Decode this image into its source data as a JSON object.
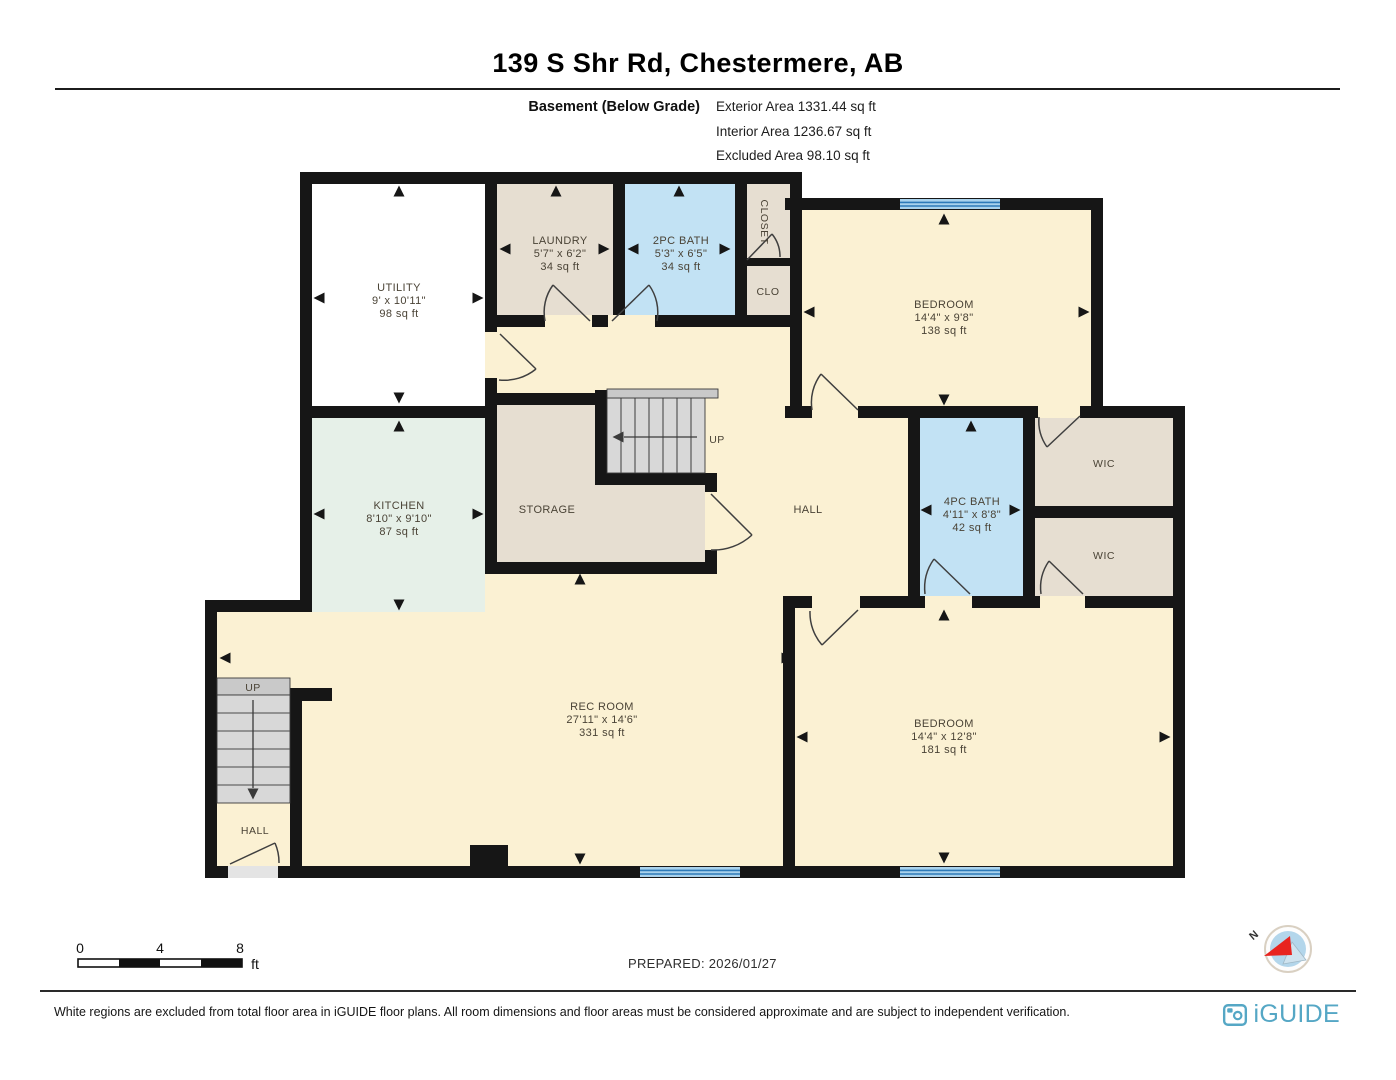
{
  "header": {
    "title": "139 S Shr Rd, Chestermere, AB",
    "floor_label": "Basement (Below Grade)",
    "area_lines": [
      "Exterior Area 1331.44 sq ft",
      "Interior Area 1236.67 sq ft",
      "Excluded Area 98.10 sq ft"
    ]
  },
  "floorplan": {
    "rooms": {
      "utility": {
        "name": "UTILITY",
        "dims": "9' x 10'11\"",
        "area": "98 sq ft"
      },
      "laundry": {
        "name": "LAUNDRY",
        "dims": "5'7\" x 6'2\"",
        "area": "34 sq ft"
      },
      "bath_2pc": {
        "name": "2PC BATH",
        "dims": "5'3\" x 6'5\"",
        "area": "34 sq ft"
      },
      "closet": {
        "name": "CLOSET"
      },
      "clo": {
        "name": "CLO"
      },
      "bedroom_upper": {
        "name": "BEDROOM",
        "dims": "14'4\" x 9'8\"",
        "area": "138 sq ft"
      },
      "kitchen": {
        "name": "KITCHEN",
        "dims": "8'10\" x 9'10\"",
        "area": "87 sq ft"
      },
      "storage": {
        "name": "STORAGE"
      },
      "hall": {
        "name": "HALL"
      },
      "bath_4pc": {
        "name": "4PC BATH",
        "dims": "4'11\" x 8'8\"",
        "area": "42 sq ft"
      },
      "wic_upper": {
        "name": "WIC"
      },
      "wic_lower": {
        "name": "WIC"
      },
      "rec_room": {
        "name": "REC ROOM",
        "dims": "27'11\" x 14'6\"",
        "area": "331 sq ft"
      },
      "bedroom_lower": {
        "name": "BEDROOM",
        "dims": "14'4\" x 12'8\"",
        "area": "181 sq ft"
      },
      "hall_lower": {
        "name": "HALL"
      }
    },
    "stairs": {
      "center_up": "UP",
      "lower_up": "UP"
    }
  },
  "scale_bar": {
    "ticks": [
      "0",
      "4",
      "8"
    ],
    "unit": "ft"
  },
  "prepared_label": "PREPARED: 2026/01/27",
  "compass": {
    "label": "N"
  },
  "footer": {
    "disclaimer": "White regions are excluded from total floor area in iGUIDE floor plans. All room dimensions and floor areas must be considered approximate and are subject to independent verification.",
    "brand": "iGUIDE"
  },
  "colors": {
    "room_cream": "#FBF1D3",
    "room_tan": "#E6DED1",
    "room_blue": "#C2E2F4",
    "room_mint": "#E6F0E8",
    "room_white": "#FFFFFF",
    "wall": "#161616",
    "window_line": "#2D7AB8",
    "brand_teal": "#55A7C5",
    "compass_red": "#E8241F"
  }
}
